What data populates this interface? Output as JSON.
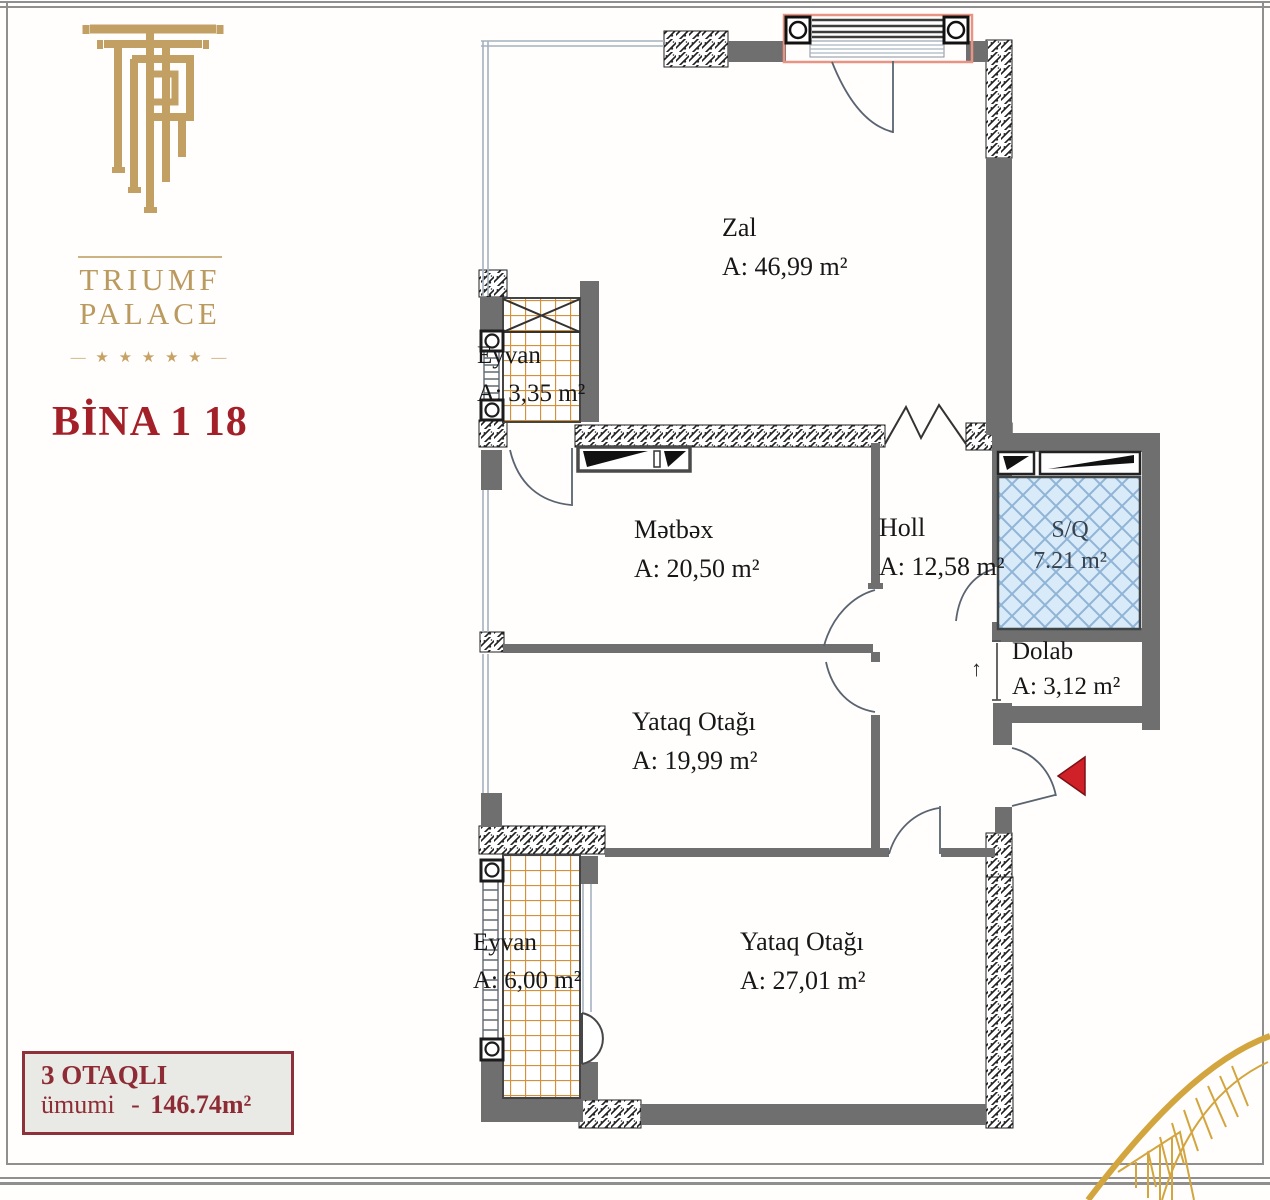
{
  "brand": {
    "name_line1": "TRIUMF",
    "name_line2": "PALACE",
    "stars_line": "— ★ ★ ★ ★ ★ —",
    "building": "BİNA 1 18"
  },
  "plan": {
    "rooms": [
      {
        "id": "zal",
        "name": "Zal",
        "area": "A: 46,99 m²"
      },
      {
        "id": "eyvan-top",
        "name": "Eyvan",
        "area": "A: 3,35 m²"
      },
      {
        "id": "metbex",
        "name": "Mətbəx",
        "area": "A: 20,50 m²"
      },
      {
        "id": "holl",
        "name": "Holl",
        "area": "A: 12,58 m²"
      },
      {
        "id": "sq",
        "name": "S/Q",
        "area": "7.21 m²"
      },
      {
        "id": "dolab",
        "name": "Dolab",
        "area": "A: 3,12 m²"
      },
      {
        "id": "yataq-1",
        "name": "Yataq Otağı",
        "area": "A: 19,99 m²"
      },
      {
        "id": "eyvan-bottom",
        "name": "Eyvan",
        "area": "A: 6,00 m²"
      },
      {
        "id": "yataq-2",
        "name": "Yataq Otağı",
        "area": "A: 27,01 m²"
      }
    ],
    "symbols": {
      "dolab_arrow": "↑"
    }
  },
  "info_box": {
    "room_count_label": "3 OTAQLI",
    "total_prefix": "ümumi",
    "total_dash": "-",
    "total_value": "146.74m²"
  },
  "colors": {
    "gold": "#c2a063",
    "brand_red": "#a32028",
    "info_red": "#8d2c34",
    "wall_gray": "#6f6f6f",
    "sq_fill": "#d9eaf8",
    "tile_orange": "#d4913c",
    "entry_arrow_red": "#cf2127"
  }
}
